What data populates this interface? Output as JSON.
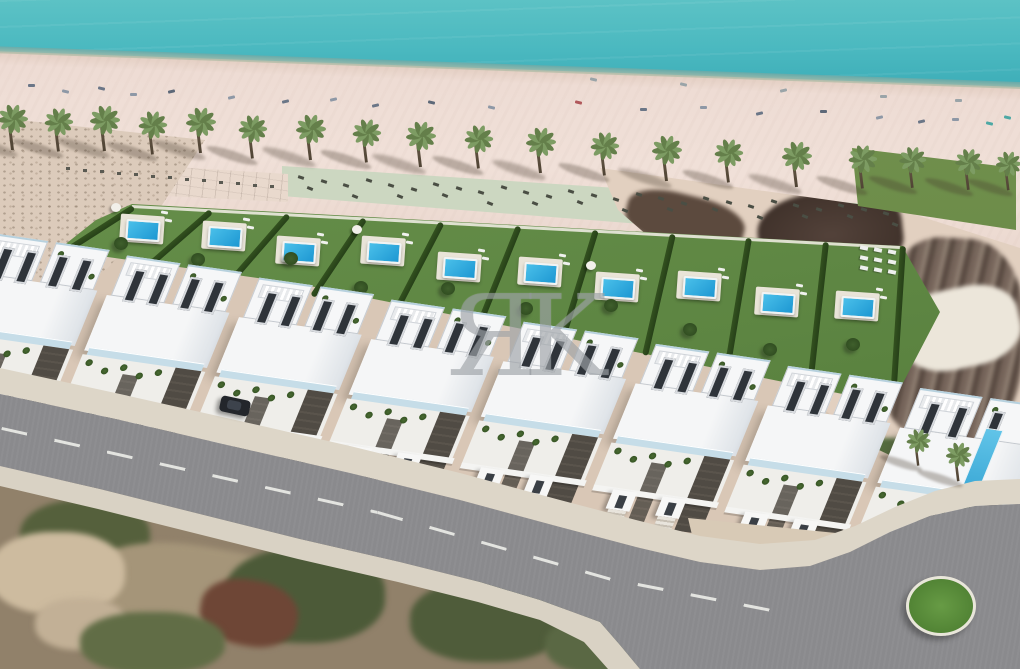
{
  "watermark": {
    "text": "ЯK"
  },
  "scene": {
    "description": "Aerial 3D render of beachfront development: row of white villas with private lawns and pools between a palm-lined beach and an access road ending in a roundabout",
    "colors": {
      "sea": "#4bb9c0",
      "sand_beach": "#eedcd4",
      "sand_scrub": "#dccbbb",
      "promenade_green": "#ccd7c1",
      "lawn": "#5d8542",
      "hedge": "#2c4a20",
      "pool_light": "#4ac0ea",
      "pool_deep": "#1d97d2",
      "villa_white": "#f5f6f7",
      "villa_shade": "#dde2e7",
      "window": "#2f343a",
      "driveway": "#514c45",
      "road": "#8a8a8d",
      "sidewalk": "#ddd6c8",
      "roundabout_island": "#588a3c",
      "car": "#23262b",
      "palm_leaf_a": "#7d9c63",
      "palm_leaf_b": "#647f4a",
      "palm_trunk": "#6b5c49",
      "terrain_green": "#4f5c3a",
      "terrain_brown": "#6e4636",
      "existing_dark": "#4a3b31"
    },
    "counts": {
      "beach_palms": 19,
      "site_palms": 2,
      "garden_plots": 10,
      "pools": 10,
      "villa_blocks": 8,
      "cars": 1,
      "roundabouts": 1
    },
    "beach_palms": [
      [
        12,
        150,
        1
      ],
      [
        58,
        153,
        0.95
      ],
      [
        104,
        151,
        1
      ],
      [
        152,
        156,
        0.95
      ],
      [
        200,
        153,
        1
      ],
      [
        252,
        160,
        0.95
      ],
      [
        310,
        160,
        1
      ],
      [
        366,
        164,
        0.95
      ],
      [
        420,
        167,
        1
      ],
      [
        478,
        170,
        0.95
      ],
      [
        540,
        173,
        1
      ],
      [
        604,
        177,
        0.95
      ],
      [
        666,
        181,
        1
      ],
      [
        728,
        184,
        0.95
      ],
      [
        796,
        187,
        1
      ],
      [
        862,
        190,
        0.95
      ],
      [
        912,
        191,
        0.9
      ],
      [
        968,
        193,
        0.9
      ],
      [
        1008,
        195,
        0.85
      ]
    ],
    "site_palms": [
      [
        918,
        472,
        0.8
      ],
      [
        958,
        486,
        0.85
      ]
    ],
    "beach_items": [
      {
        "x": 28,
        "y": 84,
        "c": "#6b7687"
      },
      {
        "x": 62,
        "y": 90,
        "c": "#8e98a6"
      },
      {
        "x": 98,
        "y": 87,
        "c": "#6b7687"
      },
      {
        "x": 130,
        "y": 93,
        "c": "#8e98a6"
      },
      {
        "x": 168,
        "y": 90,
        "c": "#5d6878"
      },
      {
        "x": 228,
        "y": 96,
        "c": "#8e98a6"
      },
      {
        "x": 282,
        "y": 100,
        "c": "#6b7687"
      },
      {
        "x": 330,
        "y": 98,
        "c": "#8e98a6"
      },
      {
        "x": 372,
        "y": 104,
        "c": "#6b7687"
      },
      {
        "x": 428,
        "y": 101,
        "c": "#5d6878"
      },
      {
        "x": 488,
        "y": 106,
        "c": "#8e98a6"
      },
      {
        "x": 575,
        "y": 101,
        "c": "#b0575a"
      },
      {
        "x": 640,
        "y": 108,
        "c": "#6b7687"
      },
      {
        "x": 700,
        "y": 106,
        "c": "#8e98a6"
      },
      {
        "x": 756,
        "y": 112,
        "c": "#6b7687"
      },
      {
        "x": 820,
        "y": 110,
        "c": "#5d6878"
      },
      {
        "x": 876,
        "y": 116,
        "c": "#8e98a6"
      },
      {
        "x": 918,
        "y": 120,
        "c": "#6b7687"
      },
      {
        "x": 952,
        "y": 118,
        "c": "#8e98a6"
      },
      {
        "x": 986,
        "y": 122,
        "c": "#4da8a4"
      },
      {
        "x": 1004,
        "y": 116,
        "c": "#4da8a4"
      },
      {
        "x": 590,
        "y": 78,
        "c": "#9aa4a8"
      },
      {
        "x": 680,
        "y": 83,
        "c": "#9aa4a8"
      },
      {
        "x": 780,
        "y": 89,
        "c": "#9aa4a8"
      },
      {
        "x": 880,
        "y": 95,
        "c": "#9aa4a8"
      },
      {
        "x": 955,
        "y": 99,
        "c": "#9aa4a8"
      }
    ],
    "promenade": {
      "lounger_rows": {
        "count": 27,
        "x0": 298,
        "dx": 22.5,
        "y0": 176,
        "dy": 1.15,
        "color": "#4a4e44"
      },
      "paved_dots": {
        "count": 13,
        "x0": 66,
        "dx": 17,
        "y0": 167,
        "dy": 1.5,
        "color": "#5a5a52"
      },
      "white_sunbeds": {
        "x0": 860,
        "y0": 246,
        "cols": 3,
        "rows": 3,
        "color": "#eef0ee"
      }
    },
    "gardens": {
      "top_edge": [
        [
          132,
          205
        ],
        [
          900,
          246
        ]
      ],
      "bottom_edge": [
        [
          62,
          250
        ],
        [
          890,
          400
        ]
      ],
      "plots": [
        {
          "pool_t": 0.56,
          "tree_t": 0.26,
          "parasol": true
        },
        {
          "pool_t": 0.6,
          "tree_t": 0.2,
          "parasol": false
        },
        {
          "pool_t": 0.5,
          "tree_t": 0.4,
          "parasol": false
        },
        {
          "pool_t": 0.62,
          "tree_t": 0.18,
          "parasol": true
        },
        {
          "pool_t": 0.54,
          "tree_t": 0.3,
          "parasol": false
        },
        {
          "pool_t": 0.58,
          "tree_t": 0.22,
          "parasol": false
        },
        {
          "pool_t": 0.52,
          "tree_t": 0.36,
          "parasol": true
        },
        {
          "pool_t": 0.6,
          "tree_t": 0.26,
          "parasol": false
        },
        {
          "pool_t": 0.55,
          "tree_t": 0.2,
          "parasol": false
        },
        {
          "pool_t": 0.58,
          "tree_t": 0.32,
          "parasol": false
        }
      ]
    },
    "villas": {
      "blocks": [
        {
          "x": 6,
          "w": 128,
          "dy": 0,
          "end": false
        },
        {
          "x": 140,
          "w": 128,
          "dy": 3,
          "end": false
        },
        {
          "x": 274,
          "w": 128,
          "dy": 6,
          "end": false
        },
        {
          "x": 408,
          "w": 128,
          "dy": 9,
          "end": false
        },
        {
          "x": 542,
          "w": 128,
          "dy": 12,
          "end": false
        },
        {
          "x": 676,
          "w": 128,
          "dy": 15,
          "end": false
        },
        {
          "x": 810,
          "w": 128,
          "dy": 18,
          "end": false
        },
        {
          "x": 944,
          "w": 146,
          "dy": 21,
          "end": true
        }
      ]
    },
    "road": {
      "dashes": [
        {
          "x": 2,
          "y": 427,
          "len": 385,
          "rot": 12.6
        },
        {
          "x": 378,
          "y": 511,
          "len": 268,
          "rot": 16.0
        },
        {
          "x": 638,
          "y": 583,
          "len": 150,
          "rot": 11.0
        }
      ]
    }
  }
}
